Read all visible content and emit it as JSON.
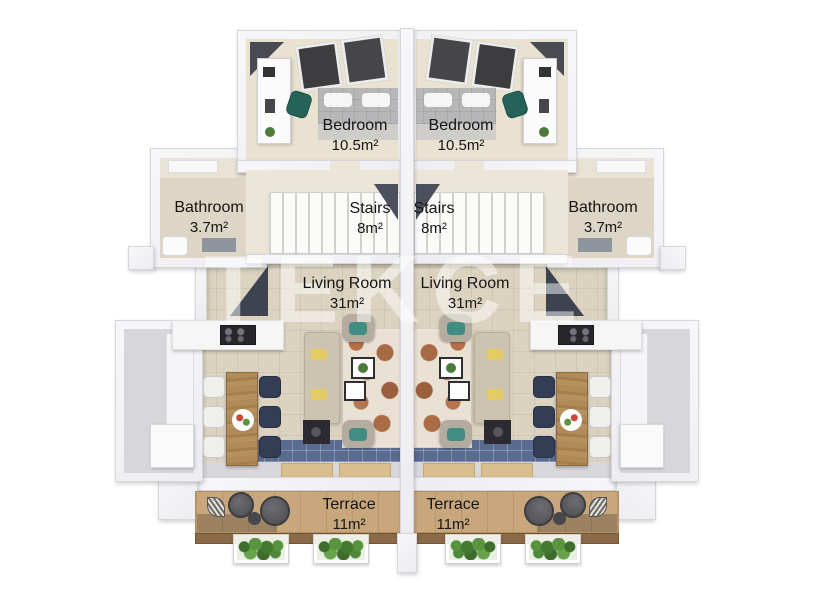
{
  "watermark": "TEKCE",
  "rooms": {
    "bedroom": {
      "name": "Bedroom",
      "area": "10.5m²"
    },
    "bathroom": {
      "name": "Bathroom",
      "area": "3.7m²"
    },
    "stairs": {
      "name": "Stairs",
      "area": "8m²"
    },
    "living_room": {
      "name": "Living Room",
      "area": "31m²"
    },
    "terrace": {
      "name": "Terrace",
      "area": "11m²"
    }
  },
  "colors": {
    "wall": "#f2f2f5",
    "bedroom_floor": "#e9e2d1",
    "living_floor": "#dbd3c0",
    "kitchen_floor": "#d7d7db",
    "terrace_deck": "#c8a77c",
    "terrace_fascia": "#8b6a47",
    "accent_teal": "#2d6a5f",
    "tile_blue": "#5a6b90",
    "label_text": "#161616",
    "watermark_color": "rgba(255,255,255,0.5)"
  }
}
